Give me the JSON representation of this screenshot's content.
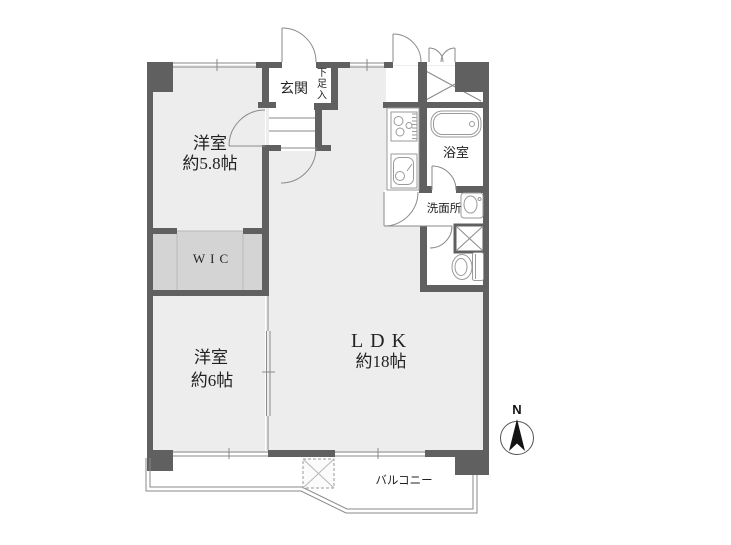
{
  "plan_title": "apartment-floor-plan",
  "rooms": {
    "bedroom1": {
      "name": "洋室",
      "size": "約5.8帖"
    },
    "wic": {
      "label": "WIC"
    },
    "bedroom2": {
      "name": "洋室",
      "size": "約6帖"
    },
    "ldk": {
      "name": "LDK",
      "size": "約18帖"
    },
    "entrance": {
      "label": "玄関"
    },
    "shoe_cabinet": {
      "label": "下足入"
    },
    "bathroom": {
      "label": "浴室"
    },
    "washroom": {
      "label": "洗面所"
    },
    "balcony": {
      "label": "バルコニー"
    }
  },
  "compass": {
    "north_label": "N"
  },
  "colors": {
    "wall": "#606060",
    "room": "#ededee",
    "closet": "#d4d4d4",
    "white": "#ffffff",
    "line": "#8a8a8a",
    "fixture": "#9a9a9a",
    "text": "#222222",
    "bg": "#ffffff"
  }
}
